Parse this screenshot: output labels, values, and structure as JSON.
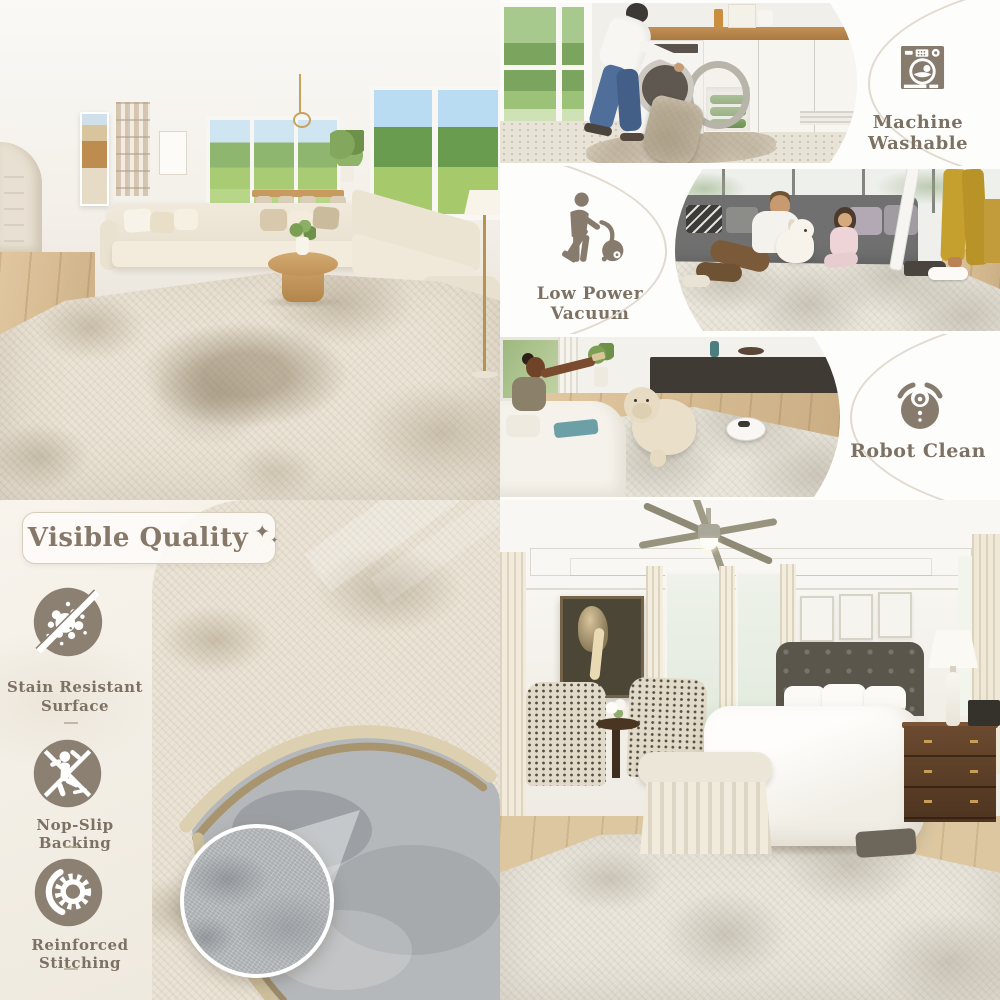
{
  "colors": {
    "accent_taupe": "#877b6e",
    "label_brown": "#7d7164",
    "pill_border": "#d7cdbd",
    "cream_bg": "#f5f1e9",
    "felt_gray": "#b5b8ba"
  },
  "features_strip": {
    "machine_washable": {
      "icon": "washing-machine-icon",
      "label": "Machine Washable"
    },
    "low_power_vacuum": {
      "icon": "person-vacuuming-icon",
      "label": "Low Power Vacuum"
    },
    "robot_clean": {
      "icon": "robot-vacuum-icon",
      "label": "Robot Clean"
    }
  },
  "visible_quality": {
    "title": "Visible Quality",
    "sparkle_large": "✦",
    "sparkle_small": "✦",
    "features": [
      {
        "icon": "stain-resistant-icon",
        "label": "Stain Resistant Surface"
      },
      {
        "icon": "non-slip-icon",
        "label": "Nop-Slip Backing"
      },
      {
        "icon": "reinforced-stitching-icon",
        "label": "Reinforced Stitching"
      }
    ]
  }
}
